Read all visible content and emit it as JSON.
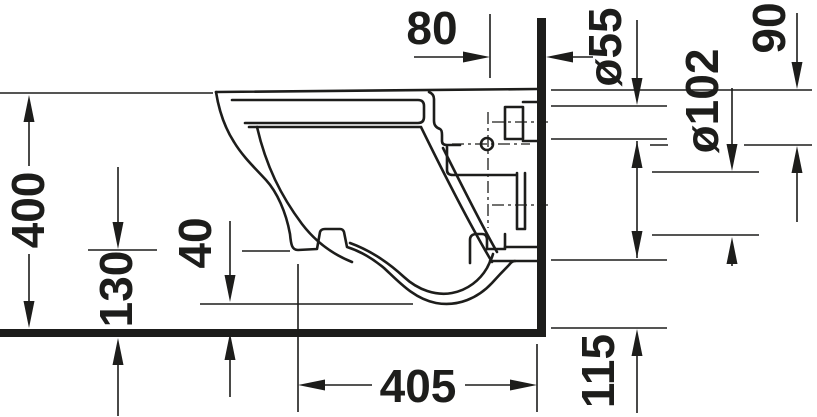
{
  "drawing": {
    "background": "#ffffff",
    "line_color": "#1d1d1b",
    "type": "technical-dimension-drawing",
    "view": "side-elevation-wall-hung-toilet"
  },
  "dimensions": {
    "d80": "80",
    "d55": "ø55",
    "d90": "90",
    "d102": "ø102",
    "d400": "400",
    "d130": "130",
    "d40": "40",
    "d405": "405",
    "d115": "115"
  }
}
